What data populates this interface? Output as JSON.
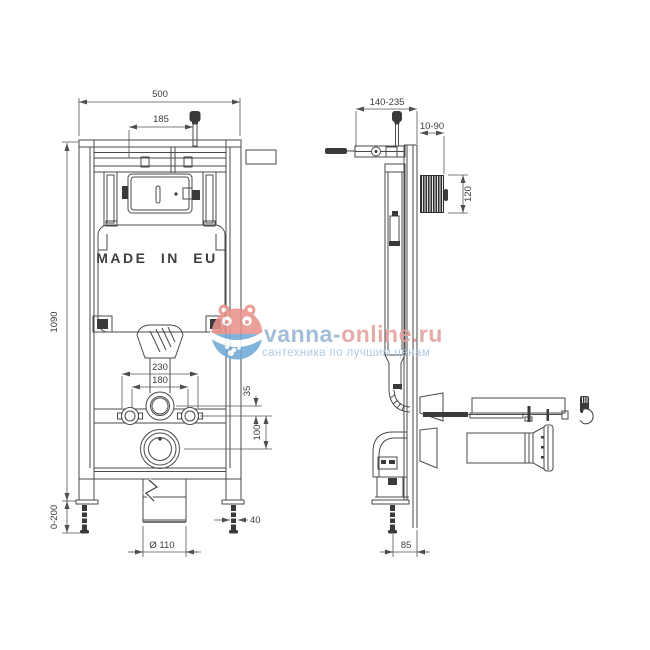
{
  "page": {
    "background": "#ffffff"
  },
  "front_view": {
    "made_in_label": "MADE IN EU",
    "dim_width": "500",
    "dim_button_offset": "185",
    "dim_height": "1090",
    "dim_feet_adjust": "0-200",
    "dim_fixing_outer": "230",
    "dim_fixing_inner": "180",
    "dim_flush_offset": "35",
    "dim_drain_offset": "100",
    "dim_foot": "40",
    "dim_drain_diameter": "Ø 110"
  },
  "side_view": {
    "dim_depth_range": "140-235",
    "dim_wall_range": "10-90",
    "dim_plate_height": "120",
    "dim_outlet_offset": "85"
  },
  "watermark": {
    "site_name_part1": "vanna-",
    "site_name_part2": "online.ru",
    "tagline": "сантехника по лучшим ценам",
    "colors": {
      "part1": "#97b4d4",
      "part2": "#e2a09d",
      "tagline": "#a7c3de",
      "logo_red": "#e8938b",
      "logo_blue": "#70a9d7"
    }
  },
  "drawing": {
    "line_color": "#4a4a4a",
    "text_color": "#3c3c3c"
  }
}
